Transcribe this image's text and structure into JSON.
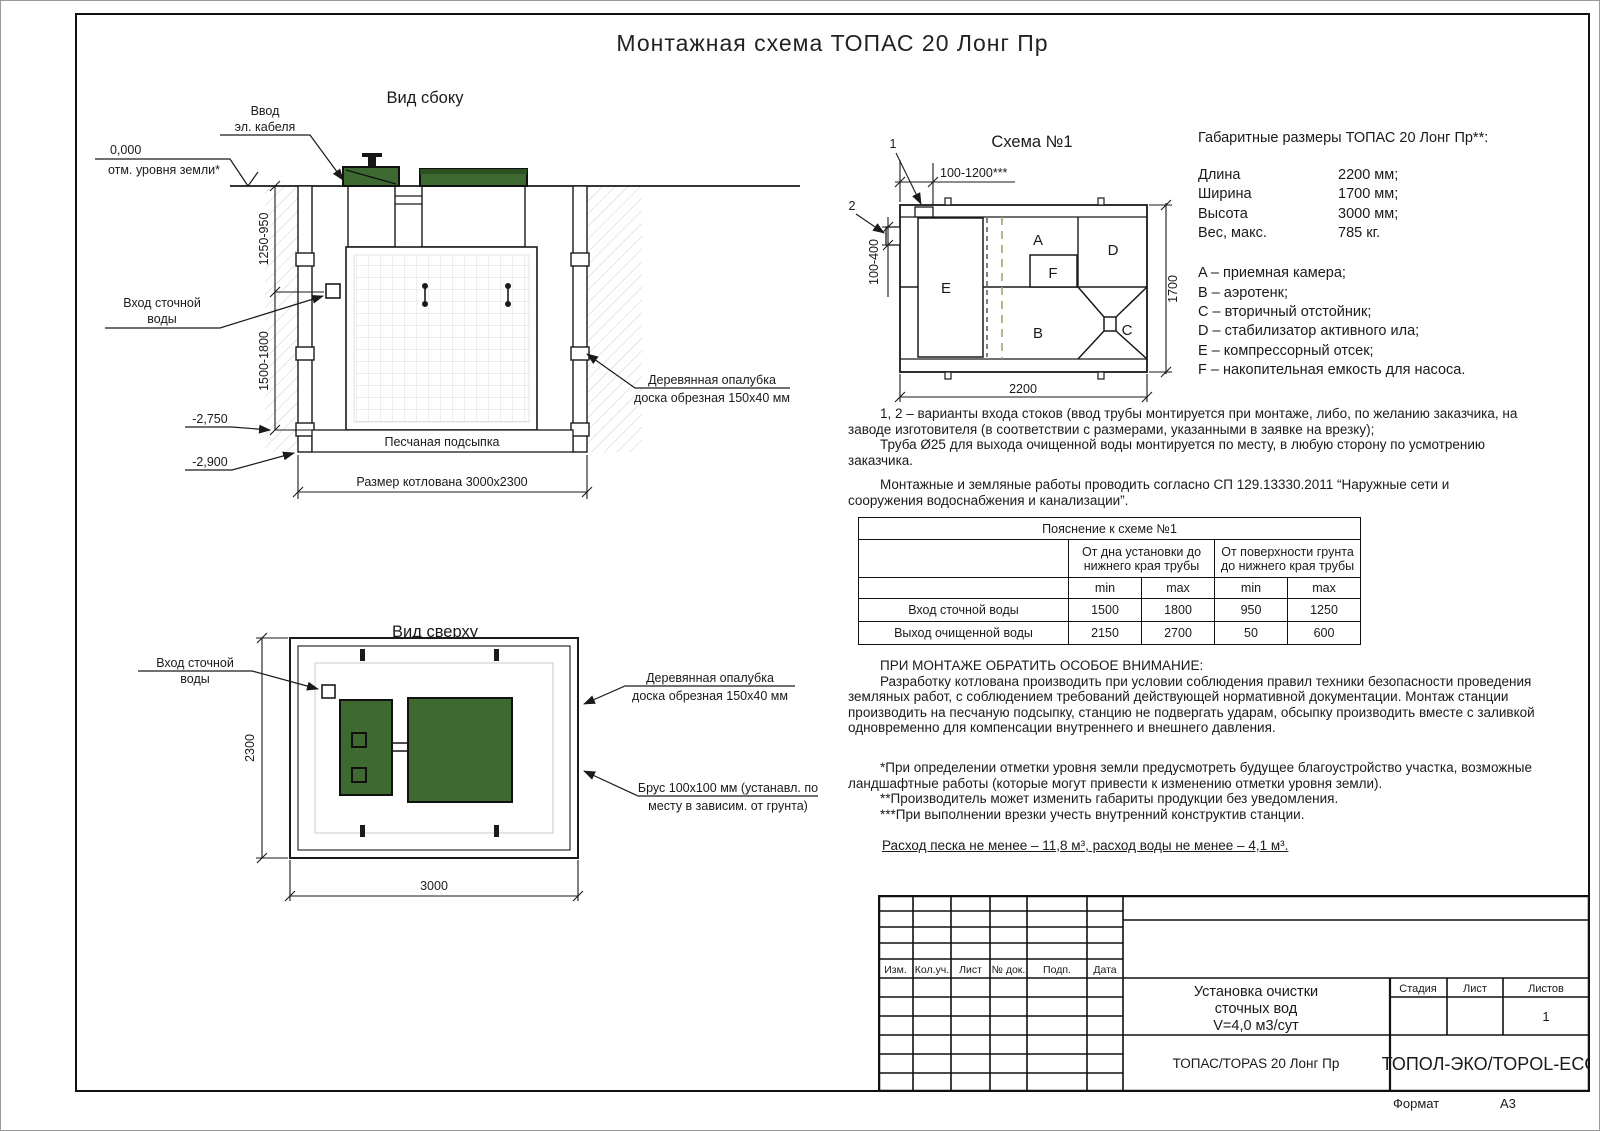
{
  "page": {
    "title": "Монтажная схема ТОПАС 20 Лонг Пр",
    "format_label": "Формат",
    "format_value": "А3"
  },
  "side_view": {
    "title": "Вид сбоку",
    "cable_label_1": "Ввод",
    "cable_label_2": "эл. кабеля",
    "zero_mark": "0,000",
    "ground_label": "отм. уровня земли*",
    "dim_upper": "1250-950",
    "dim_lower": "1500-1800",
    "inlet_label_1": "Вход сточной",
    "inlet_label_2": "воды",
    "level_tank_bottom": "-2,750",
    "level_pit_bottom": "-2,900",
    "sand_label": "Песчаная подсыпка",
    "pit_size_label": "Размер котлована 3000х2300",
    "formwork_label_1": "Деревянная опалубка",
    "formwork_label_2": "доска обрезная 150х40 мм"
  },
  "schema": {
    "title": "Схема №1",
    "mark_1": "1",
    "mark_2": "2",
    "dim_top": "100-1200***",
    "dim_left": "100-400",
    "dim_bottom": "2200",
    "dim_right": "1700",
    "chamber_a": "A",
    "chamber_b": "B",
    "chamber_c": "C",
    "chamber_d": "D",
    "chamber_e": "E",
    "chamber_f": "F"
  },
  "overall": {
    "title": "Габаритные размеры ТОПАС 20 Лонг Пр**:",
    "rows": [
      {
        "label": "Длина",
        "value": "2200 мм;"
      },
      {
        "label": "Ширина",
        "value": "1700 мм;"
      },
      {
        "label": "Высота",
        "value": "3000 мм;"
      },
      {
        "label": "Вес, макс.",
        "value": "785 кг."
      }
    ],
    "legend": [
      "A – приемная камера;",
      "B – аэротенк;",
      "C – вторичный отстойник;",
      "D – стабилизатор активного ила;",
      "E – компрессорный отсек;",
      "F – накопительная емкость для насоса."
    ]
  },
  "notes": {
    "variants": "1, 2 – варианты входа стоков (ввод трубы монтируется при монтаже, либо, по желанию заказчика, на заводе изготовителя (в соответствии с размерами, указанными в заявке на врезку);",
    "pipe": "Труба Ø25 для выхода очищенной воды монтируется по месту, в любую сторону по усмотрению заказчика.",
    "works": "Монтажные и земляные работы проводить согласно СП 129.13330.2011 “Наружные сети и сооружения водоснабжения и канализации”.",
    "attention_title": "ПРИ МОНТАЖЕ ОБРАТИТЬ ОСОБОЕ ВНИМАНИЕ:",
    "attention_body": "Разработку котлована производить при условии соблюдения правил техники безопасности проведения земляных работ, с соблюдением требований действующей нормативной документации. Монтаж станции производить на песчаную подсыпку, станцию не подвергать ударам, обсыпку производить вместе с заливкой одновременно для компенсации внутреннего и внешнего давления.",
    "footnote_1": "*При определении отметки уровня земли предусмотреть будущее благоустройство участка, возможные ландшафтные работы (которые могут привести к изменению отметки уровня земли).",
    "footnote_2": "**Производитель может изменить габариты продукции без уведомления.",
    "footnote_3": "***При выполнении врезки учесть внутренний конструктив станции.",
    "consumption": "Расход песка не менее – 11,8 м³, расход воды не менее – 4,1 м³."
  },
  "pipe_table": {
    "title": "Пояснение к схеме №1",
    "group_1": "От дна установки до нижнего края трубы",
    "group_2": "От поверхности грунта до нижнего края трубы",
    "min": "min",
    "max": "max",
    "rows": [
      {
        "label": "Вход сточной воды",
        "v1": "1500",
        "v2": "1800",
        "v3": "950",
        "v4": "1250"
      },
      {
        "label": "Выход очищенной воды",
        "v1": "2150",
        "v2": "2700",
        "v3": "50",
        "v4": "600"
      }
    ]
  },
  "top_view": {
    "title": "Вид сверху",
    "inlet_label_1": "Вход сточной",
    "inlet_label_2": "воды",
    "dim_height": "2300",
    "dim_width": "3000",
    "formwork_label_1": "Деревянная опалубка",
    "formwork_label_2": "доска обрезная 150х40 мм",
    "beam_label_1": "Брус 100х100 мм (устанавл. по",
    "beam_label_2": "месту в зависим. от грунта)"
  },
  "stamp": {
    "headers": [
      "Изм.",
      "Кол.уч.",
      "Лист",
      "№ док.",
      "Подп.",
      "Дата"
    ],
    "doc_name_1": "Установка очистки",
    "doc_name_2": "сточных вод",
    "doc_name_3": "V=4,0 м3/сут",
    "product": "ТОПАС/TOPAS 20 Лонг Пр",
    "company": "ТОПОЛ-ЭКО/TOPOL-ECO",
    "stage_label": "Стадия",
    "sheet_label": "Лист",
    "sheets_label": "Листов",
    "sheets_value": "1"
  },
  "colors": {
    "lid_green": "#3e6a31",
    "lid_green_dark": "#2c501f",
    "line": "#1a1a1a",
    "dashed_green": "#8fae6f"
  }
}
